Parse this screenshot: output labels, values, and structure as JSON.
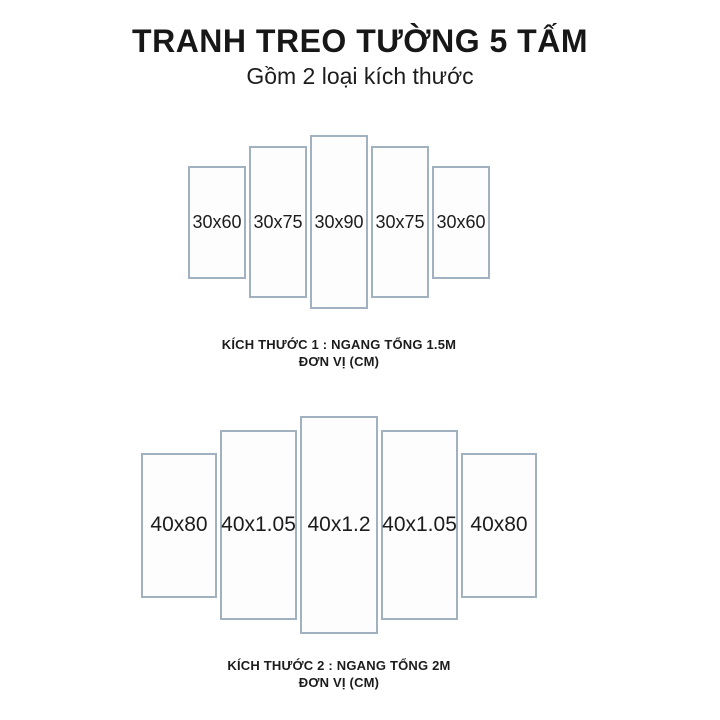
{
  "header": {
    "title": "TRANH TREO TƯỜNG 5 TẤM",
    "subtitle": "Gồm 2 loại kích thước"
  },
  "groups": [
    {
      "name": "kich-thuoc-1",
      "panels": [
        "30x60",
        "30x75",
        "30x90",
        "30x75",
        "30x60"
      ],
      "caption_line1": "KÍCH THƯỚC 1 : NGANG TỔNG 1.5M",
      "caption_line2": "ĐƠN VỊ (CM)"
    },
    {
      "name": "kich-thuoc-2",
      "panels": [
        "40x80",
        "40x1.05",
        "40x1.2",
        "40x1.05",
        "40x80"
      ],
      "caption_line1": "KÍCH THƯỚC 2 : NGANG TỔNG 2M",
      "caption_line2": "ĐƠN VỊ (CM)"
    }
  ],
  "colors": {
    "panel_border": "#a2b1c0",
    "text": "#1c1c1c",
    "background": "#ffffff"
  }
}
